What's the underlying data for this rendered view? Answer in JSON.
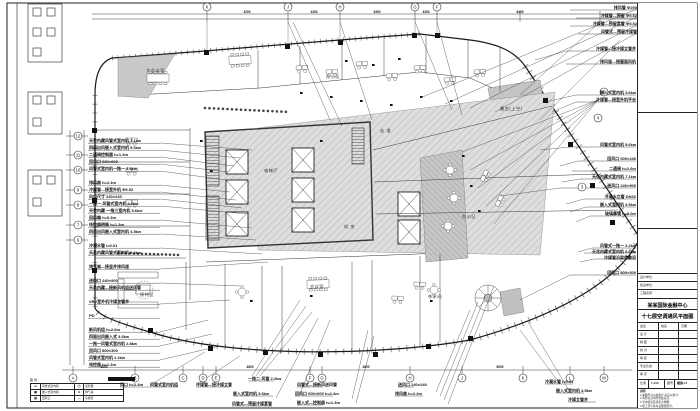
{
  "ann": {
    "left": [
      "天花内藏风管式室内机 7.1kw",
      "四面出风嵌入式室内机 5.6kw",
      "二通阀控制器 h=1.3m",
      "回风口 600×600",
      "风管式室内机一拖一 3.6kw",
      "排风扇 h=2.4m",
      "冷媒管—接室外机 Φ9.52",
      "风口尺寸 240×240",
      "一拖一·风管式室内机 2.2kw",
      "天花内藏·一拖三室内机 5.6kw",
      "回风箱 h=0.3m",
      "线控器明装 h=1.3m",
      "四面出风嵌入式室内机 4.5kw",
      "冷凝水管 i=0.01",
      "天花内藏风管式室内机 5.6kw",
      "排气扇—接竖井排风道",
      "送风口 240×900",
      "天花内藏—接新风机组送风管",
      "VRV室外机冷媒立管井",
      "PD",
      "新风机组 h=2.6m",
      "四面出风嵌入式 3.6kw",
      "一拖一风管式室内机 2.8kw",
      "回风口 800×300",
      "风管式室内机 2.2kw",
      "线控器 h=1.3m"
    ],
    "right": [
      "冷媒管—接冷媒立管井",
      "排风道—接屋面风机",
      "嵌入式室内机 3.6kw",
      "冷媒管—接室外机平台",
      "风管式室内机 5.6kw",
      "回风口 600×240",
      "二通阀 h=2.6m",
      "天花内藏式室内机 7.1kw",
      "送风口 240×900",
      "冷凝水立管 DN32",
      "嵌入式室内机 4.5kw",
      "玻璃幕墙 h=3.0m",
      "风管式一拖一 2.2kw",
      "天花内藏式室内机 5.6kw",
      "冷媒管沿梁底敷设",
      "回风口 800×300"
    ],
    "topright": [
      "排风管 Φ250",
      "冷媒管—预留 Φ9.52",
      "冷媒管—预留套管 Φ9.52",
      "风管式—预留冷媒管"
    ],
    "bottom": [
      "风口 h=2.4m",
      "风管式室内机组",
      "冷媒管—接冷媒立管",
      "一拖二·风管 2.2kw",
      "嵌入式室内机 3.6kw",
      "风管式—预留冷媒套管",
      "风管式—接新风送风管",
      "回风口 600×600 h=2.4m",
      "嵌入式—控制器 h=1.3m",
      "送风口 240×240",
      "排风扇 h=2.4m",
      "冷凝水管 i=0.01",
      "嵌入式室内机 4.5kw",
      "冷媒立管井"
    ],
    "inner": [
      "大会议室",
      "办公区",
      "电梯厅",
      "走 道",
      "机 房",
      "办公区",
      "露台(上空)",
      "会议室",
      "接待区",
      "茶水间"
    ]
  },
  "bub": {
    "top": [
      "K",
      "J",
      "H",
      "G",
      "F"
    ],
    "left": [
      "12",
      "11",
      "10",
      "9",
      "8",
      "7",
      "6"
    ],
    "bottom": [
      "A",
      "B",
      "C",
      "D",
      "E",
      "F",
      "G",
      "H",
      "J",
      "K",
      "L",
      "M"
    ],
    "right": [
      "5",
      "4",
      "3"
    ]
  },
  "dims": {
    "top": [
      "4200",
      "4200",
      "5400",
      "4200",
      "8400"
    ],
    "bottom": [
      "3600",
      "4800",
      "4800",
      "6000"
    ]
  },
  "legend": {
    "title": "图 例",
    "note": "注:尺寸均以mm计",
    "rows": [
      {
        "a": "▭",
        "b": "风管式室内机",
        "c": "Ⓣ",
        "d": "温控器"
      },
      {
        "a": "▣",
        "b": "嵌入式室内机",
        "c": "⊙",
        "d": "排气扇"
      },
      {
        "a": "▨",
        "b": "回风口",
        "c": "—",
        "d": "冷媒管"
      }
    ]
  },
  "tb": {
    "f1": "设计单位",
    "f2": "建设单位",
    "f3": "工程名称",
    "t1": "某某国际金融中心",
    "t2": "十七层空调通风平面图",
    "th": {
      "c1": "会签",
      "c2": "姓名",
      "c3": "日期"
    },
    "rows": [
      "设 计",
      "制 图",
      "校 对",
      "审 核",
      "专业负责",
      "审 定"
    ],
    "scale_label": "比例",
    "scale": "1:100",
    "no_label": "图号",
    "no": "暖施-17",
    "notes": [
      "说明:",
      "1.本图尺寸以毫米计,标高以米计;",
      "2.风管标高均为管底标高;",
      "3.室内机安装详见大样图;",
      "4.施工须与各专业图纸配合。"
    ]
  }
}
